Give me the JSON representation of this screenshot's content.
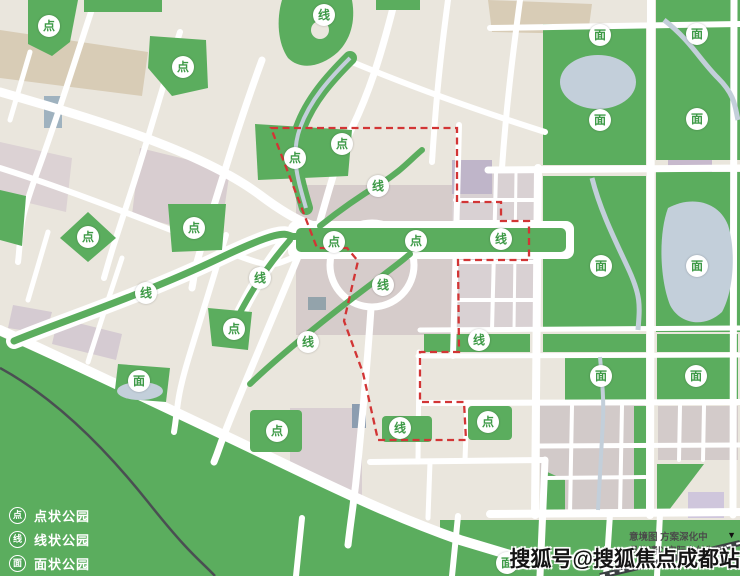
{
  "map": {
    "badges": [
      {
        "type": "dot",
        "label": "点",
        "x": 49,
        "y": 26
      },
      {
        "type": "dot",
        "label": "点",
        "x": 183,
        "y": 67
      },
      {
        "type": "dot",
        "label": "点",
        "x": 295,
        "y": 158
      },
      {
        "type": "dot",
        "label": "点",
        "x": 342,
        "y": 144
      },
      {
        "type": "dot",
        "label": "点",
        "x": 194,
        "y": 228
      },
      {
        "type": "dot",
        "label": "点",
        "x": 88,
        "y": 237
      },
      {
        "type": "dot",
        "label": "点",
        "x": 334,
        "y": 242
      },
      {
        "type": "dot",
        "label": "点",
        "x": 416,
        "y": 241
      },
      {
        "type": "dot",
        "label": "点",
        "x": 234,
        "y": 329
      },
      {
        "type": "dot",
        "label": "点",
        "x": 277,
        "y": 431
      },
      {
        "type": "dot",
        "label": "点",
        "x": 488,
        "y": 422
      },
      {
        "type": "line",
        "label": "线",
        "x": 324,
        "y": 15
      },
      {
        "type": "line",
        "label": "线",
        "x": 378,
        "y": 186
      },
      {
        "type": "line",
        "label": "线",
        "x": 501,
        "y": 239
      },
      {
        "type": "line",
        "label": "线",
        "x": 260,
        "y": 278
      },
      {
        "type": "line",
        "label": "线",
        "x": 383,
        "y": 285
      },
      {
        "type": "line",
        "label": "线",
        "x": 146,
        "y": 293
      },
      {
        "type": "line",
        "label": "线",
        "x": 308,
        "y": 342
      },
      {
        "type": "line",
        "label": "线",
        "x": 479,
        "y": 340
      },
      {
        "type": "line",
        "label": "线",
        "x": 400,
        "y": 428
      },
      {
        "type": "area",
        "label": "面",
        "x": 600,
        "y": 35
      },
      {
        "type": "area",
        "label": "面",
        "x": 697,
        "y": 34
      },
      {
        "type": "area",
        "label": "面",
        "x": 600,
        "y": 120
      },
      {
        "type": "area",
        "label": "面",
        "x": 697,
        "y": 119
      },
      {
        "type": "area",
        "label": "面",
        "x": 601,
        "y": 266
      },
      {
        "type": "area",
        "label": "面",
        "x": 697,
        "y": 266
      },
      {
        "type": "area",
        "label": "面",
        "x": 601,
        "y": 376
      },
      {
        "type": "area",
        "label": "面",
        "x": 696,
        "y": 376
      },
      {
        "type": "area",
        "label": "面",
        "x": 139,
        "y": 381
      },
      {
        "type": "area",
        "label": "面",
        "x": 507,
        "y": 563
      }
    ]
  },
  "legend": {
    "items": [
      {
        "icon": "点",
        "label": "点状公园"
      },
      {
        "icon": "线",
        "label": "线状公园"
      },
      {
        "icon": "面",
        "label": "面状公园"
      }
    ]
  },
  "watermark": {
    "text": "搜狐号@搜狐焦点成都站"
  },
  "disclaimer": {
    "line1": "意境图  方案深化中",
    "line2": "具体请以实际交付为准",
    "triangle": "▼"
  },
  "colors": {
    "park_green": "#5BAD5E",
    "badge_text_green": "#3E9A47",
    "boundary_red": "#D23535",
    "water": "#C3CFDA",
    "legend_text": "#FFFFFF"
  }
}
